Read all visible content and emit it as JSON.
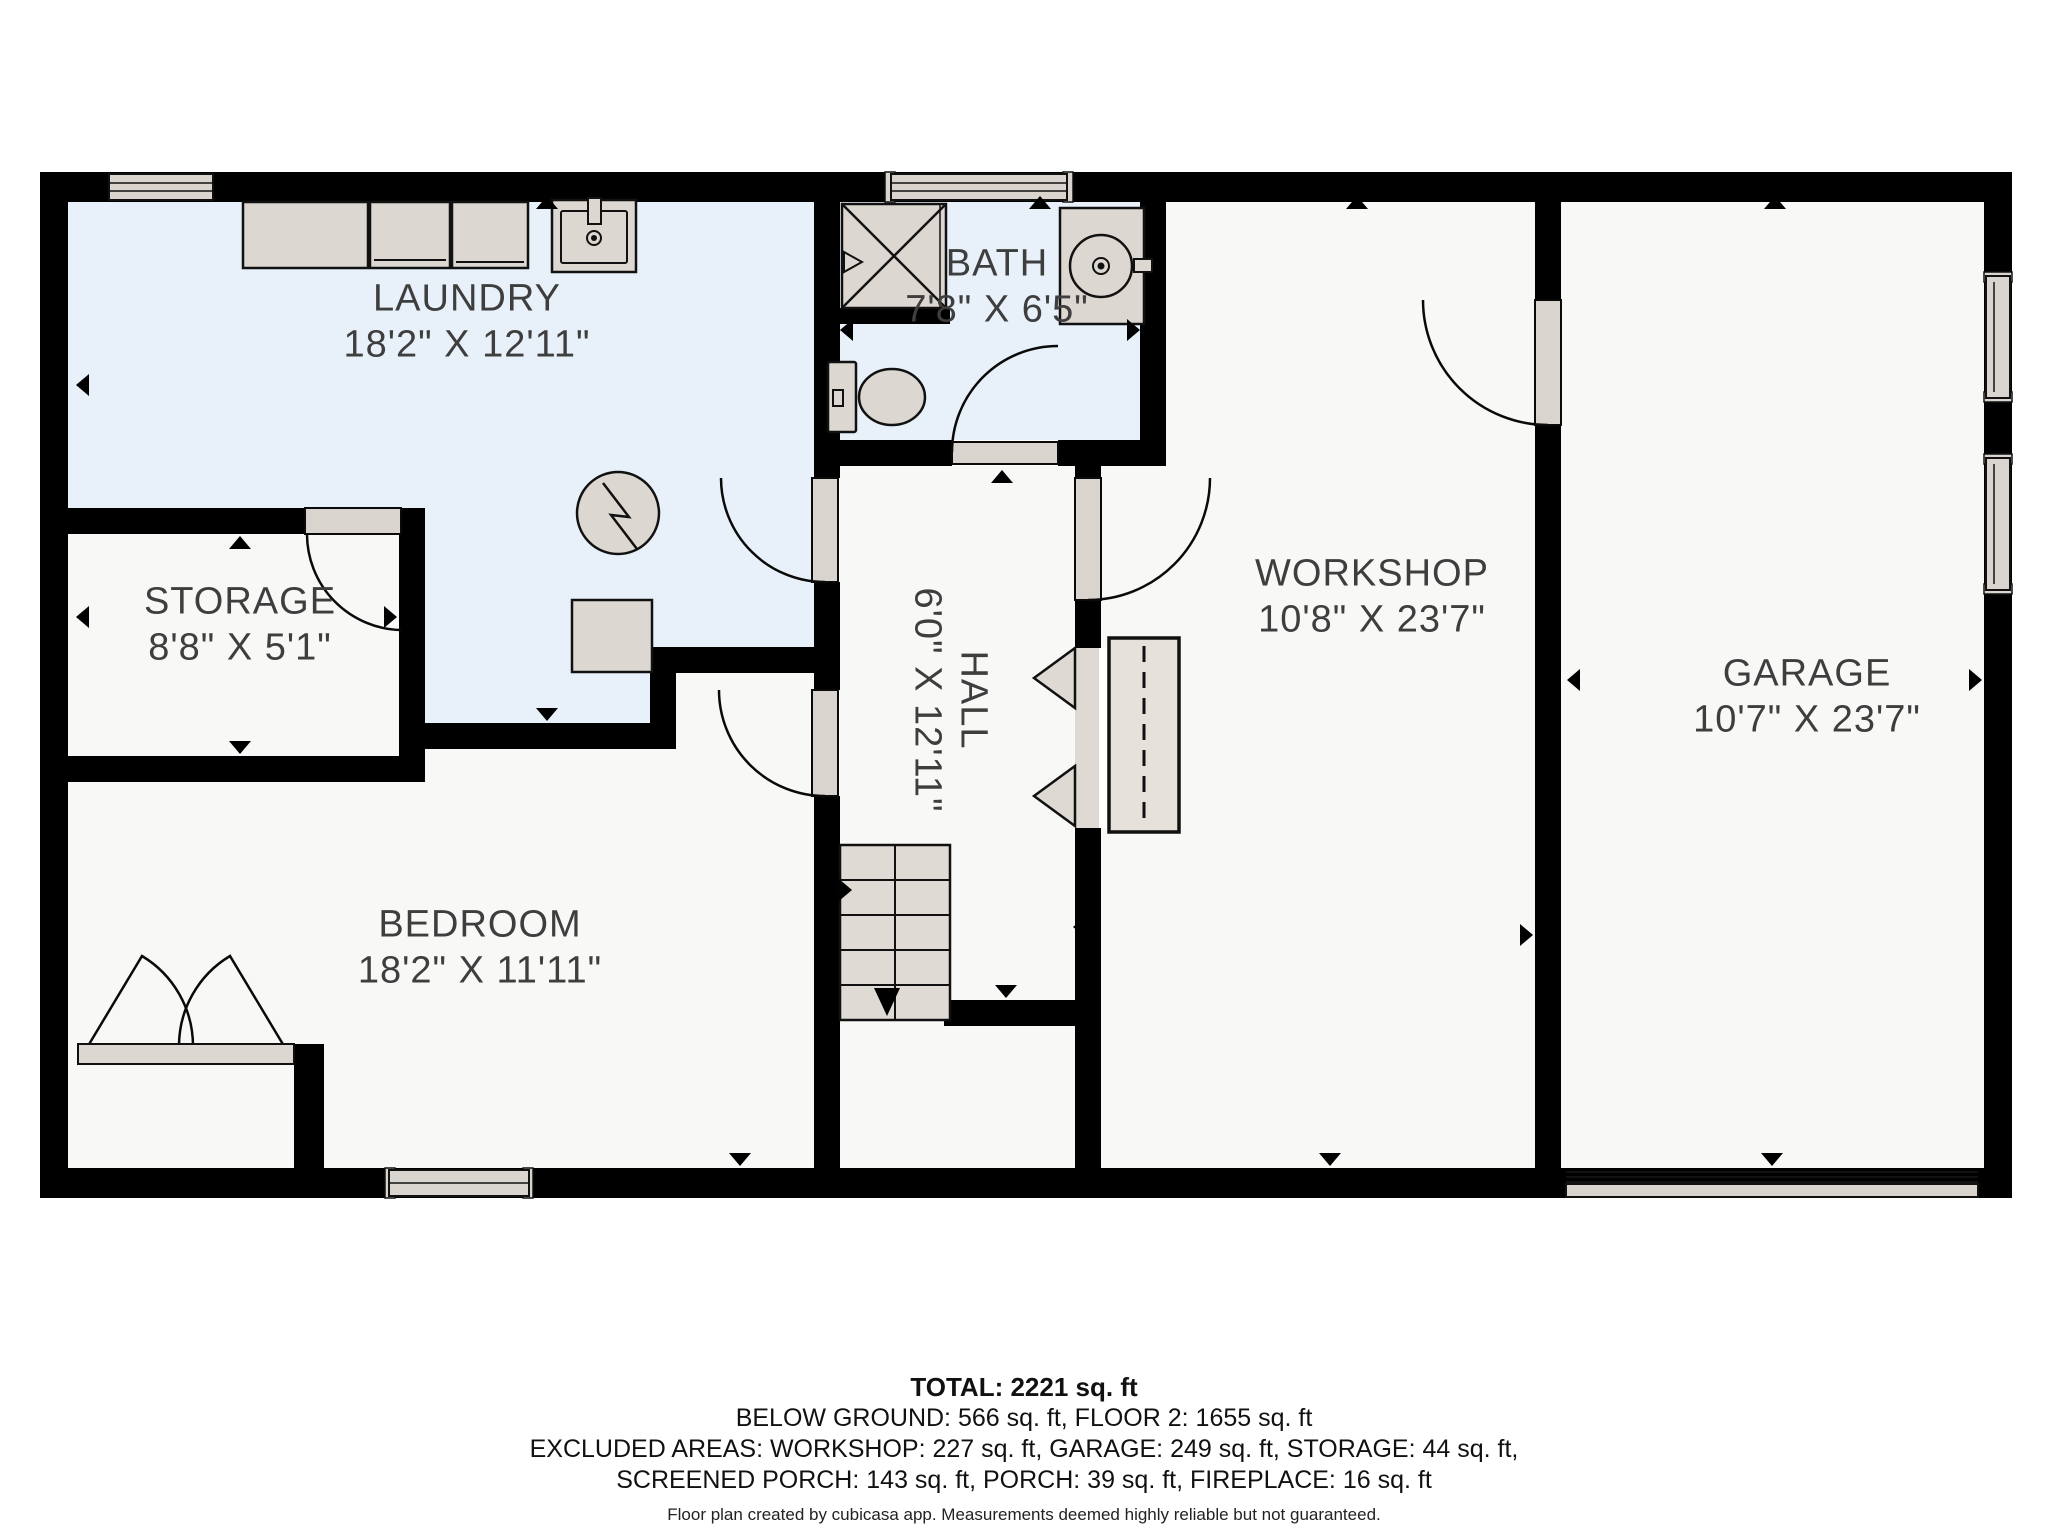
{
  "floorplan": {
    "title": "Below ground floor plan",
    "rooms": [
      {
        "id": "laundry",
        "name": "LAUNDRY",
        "dims": "18'2\" X 12'11\""
      },
      {
        "id": "bath",
        "name": "BATH",
        "dims": "7'8\" X 6'5\""
      },
      {
        "id": "storage",
        "name": "STORAGE",
        "dims": "8'8\" X 5'1\""
      },
      {
        "id": "hall",
        "name": "HALL",
        "dims": "6'0\" X 12'11\""
      },
      {
        "id": "workshop",
        "name": "WORKSHOP",
        "dims": "10'8\" X 23'7\""
      },
      {
        "id": "garage",
        "name": "GARAGE",
        "dims": "10'7\" X 23'7\""
      },
      {
        "id": "bedroom",
        "name": "BEDROOM",
        "dims": "18'2\" X 11'11\""
      }
    ],
    "summary": {
      "total": "TOTAL: 2221 sq. ft",
      "line1": "BELOW GROUND: 566 sq. ft, FLOOR 2: 1655 sq. ft",
      "line2": "EXCLUDED AREAS: WORKSHOP: 227 sq. ft, GARAGE: 249 sq. ft, STORAGE: 44 sq. ft,",
      "line3": "SCREENED PORCH: 143 sq. ft, PORCH: 39 sq. ft, FIREPLACE: 16 sq. ft",
      "disclaimer": "Floor plan created by cubicasa app. Measurements deemed highly reliable but not guaranteed."
    },
    "colors": {
      "wall": "#000000",
      "wet_room_floor": "#e8f1fa",
      "room_floor": "#f8f8f7",
      "fixture": "#dcd8d1",
      "label_text": "#3e3e3e"
    }
  }
}
